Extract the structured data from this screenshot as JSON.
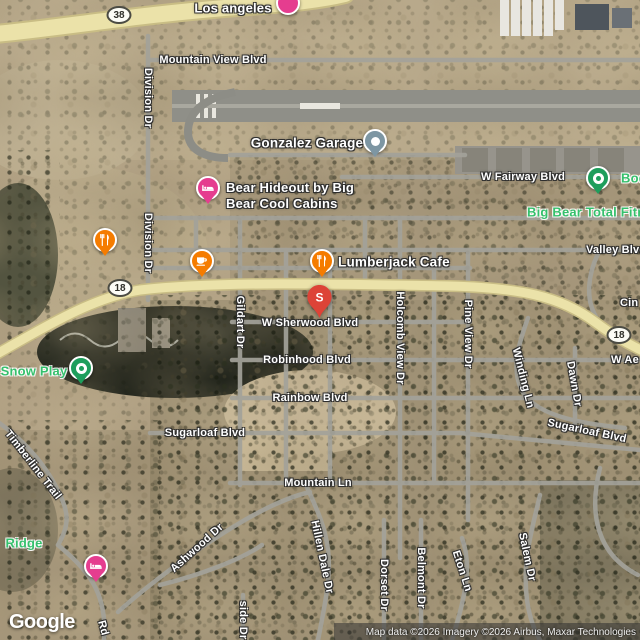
{
  "map": {
    "google_logo": "Google",
    "attribution": "Map data ©2026 Imagery ©2026 Airbus, Maxar Technologies",
    "route_badges": [
      {
        "label": "38"
      },
      {
        "label": "18"
      },
      {
        "label": "18"
      }
    ],
    "road_labels": [
      {
        "text": "Los angeles"
      },
      {
        "text": "Mountain View Blvd"
      },
      {
        "text": "Division Dr"
      },
      {
        "text": "Division Dr"
      },
      {
        "text": "W Fairway Blvd"
      },
      {
        "text": "Valley Blvd"
      },
      {
        "text": "W Sherwood Blvd"
      },
      {
        "text": "Gildart Dr"
      },
      {
        "text": "Robinhood Blvd"
      },
      {
        "text": "Rainbow Blvd"
      },
      {
        "text": "Sugarloaf Blvd"
      },
      {
        "text": "Sugarloaf Blvd"
      },
      {
        "text": "Mountain Ln"
      },
      {
        "text": "Timberline Trail"
      },
      {
        "text": "Holcomb View Dr"
      },
      {
        "text": "Pine View Dr"
      },
      {
        "text": "Winding Ln"
      },
      {
        "text": "Dawn Dr"
      },
      {
        "text": "W Ae"
      },
      {
        "text": "Cin"
      },
      {
        "text": "Salem Dr"
      },
      {
        "text": "Belmont Dr"
      },
      {
        "text": "Eton Ln"
      },
      {
        "text": "Dorset Dr"
      },
      {
        "text": "Hillen Dale Dr"
      },
      {
        "text": "Ashwood Dr"
      },
      {
        "text": "side Dr"
      },
      {
        "text": "Rd"
      }
    ],
    "poi_labels": [
      {
        "text": "Gonzalez Garage",
        "color": "white"
      },
      {
        "text": "Bear Hideout by Big Bear Cool Cabins",
        "color": "white"
      },
      {
        "text": "Lumberjack Cafe",
        "color": "white"
      },
      {
        "text": "Big Bear Total Fitne",
        "color": "green"
      },
      {
        "text": "Snow Play",
        "color": "green"
      },
      {
        "text": "Ridge",
        "color": "green"
      },
      {
        "text": "Bodf",
        "color": "green"
      }
    ],
    "markers": [
      {
        "type": "lodging",
        "icon": "none"
      },
      {
        "type": "garage",
        "icon": "dot-icon"
      },
      {
        "type": "lodging",
        "icon": "bed-icon"
      },
      {
        "type": "restaurant",
        "icon": "fork-knife-icon"
      },
      {
        "type": "cafe",
        "icon": "coffee-cup-icon"
      },
      {
        "type": "restaurant",
        "icon": "fork-knife-icon"
      },
      {
        "type": "search-result",
        "icon": "letter-pin-icon",
        "label": "S"
      },
      {
        "type": "place",
        "icon": "ring-dot-icon"
      },
      {
        "type": "place",
        "icon": "ring-dot-icon"
      },
      {
        "type": "lodging",
        "icon": "bed-icon"
      }
    ],
    "colors": {
      "marker_pink": "#e53d8f",
      "marker_orange": "#f57c00",
      "marker_green": "#1e9e5c",
      "marker_slate": "#7d96a3",
      "marker_red": "#dd4337",
      "poi_green_text": "#35c06c",
      "highway_yellow": "#ebe2a9",
      "road_gray": "#a3a29a"
    }
  }
}
